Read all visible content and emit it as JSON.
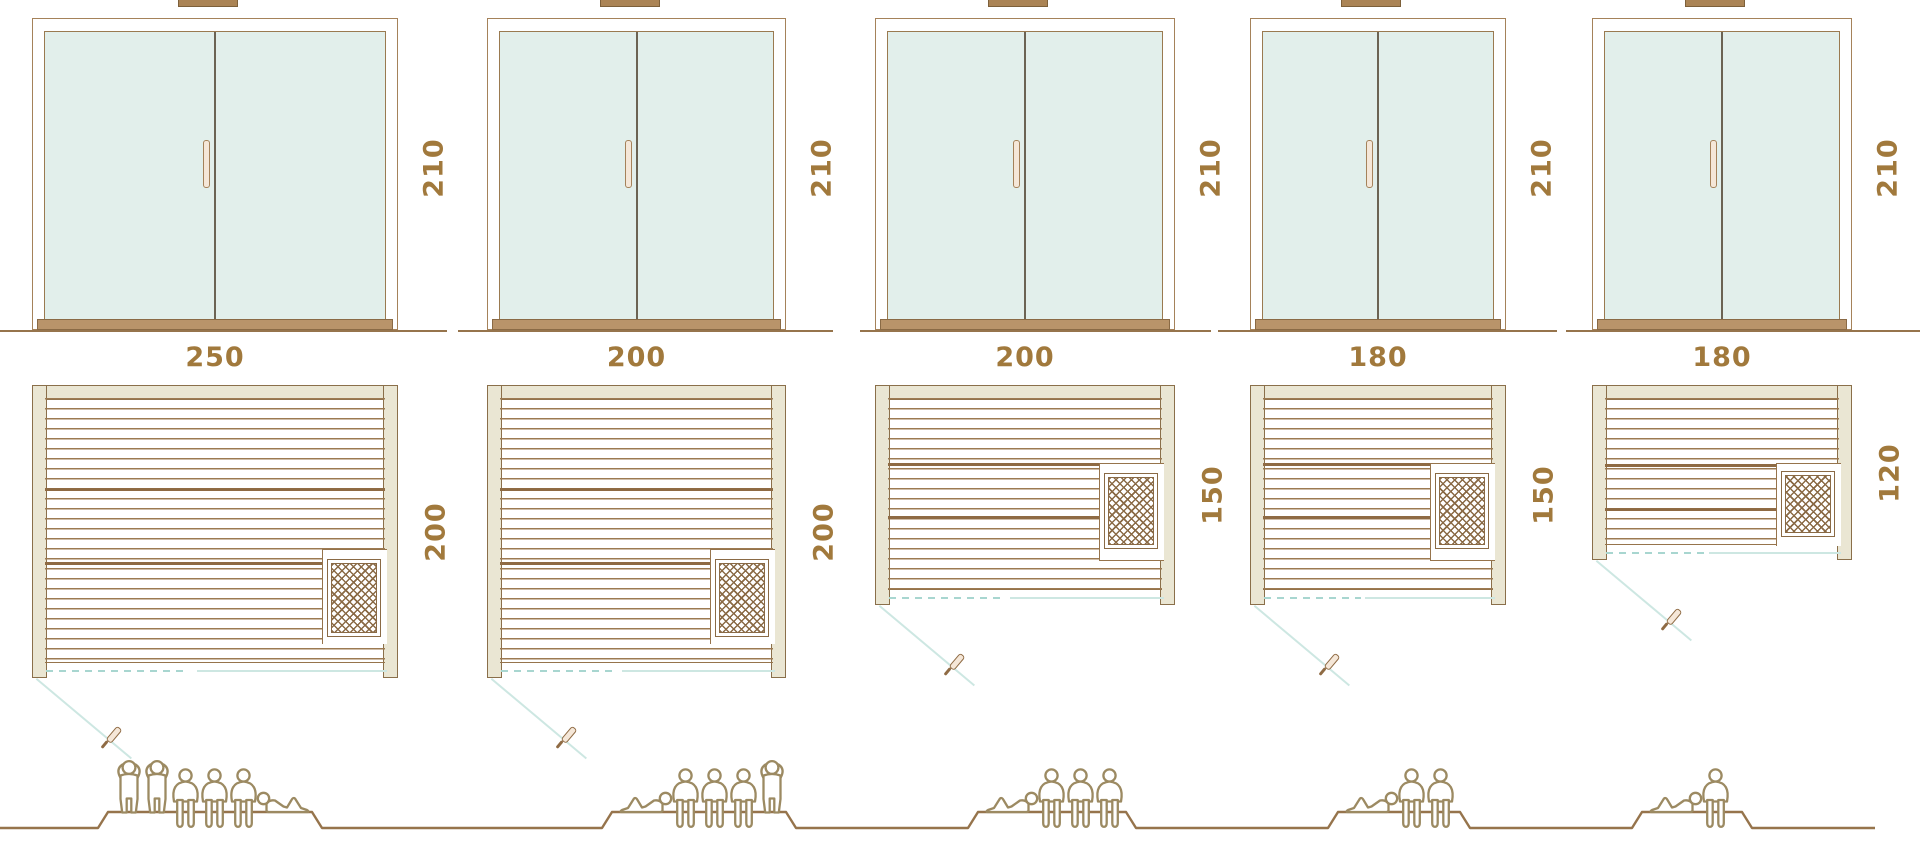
{
  "diagram": {
    "name": "sauna-size-comparison",
    "views": [
      "front-elevation",
      "floor-plan",
      "capacity"
    ]
  },
  "palette": {
    "line_brown": "#96744c",
    "frame_tan": "#a5825a",
    "dim_text": "#a1793c",
    "glass": "#e2efeb",
    "beige_fill": "#eae6d3",
    "swing_teal": "#cde7e2",
    "people_brown": "#9c8a62",
    "handle_cream": "#f5e7d8"
  },
  "units": [
    {
      "name": "sauna-250x200",
      "height_label": "210",
      "width_label": "250",
      "depth_label": "200",
      "capacity": 6,
      "people": [
        "standing",
        "standing",
        "sitting",
        "sitting",
        "sitting",
        "lying_right"
      ],
      "heater_position": "bottom-right",
      "door": "double-glass"
    },
    {
      "name": "sauna-200x200",
      "height_label": "210",
      "width_label": "200",
      "depth_label": "200",
      "capacity": 5,
      "people": [
        "lying_left",
        "sitting",
        "sitting",
        "sitting",
        "standing"
      ],
      "heater_position": "bottom-right",
      "door": "double-glass"
    },
    {
      "name": "sauna-200x150",
      "height_label": "210",
      "width_label": "200",
      "depth_label": "150",
      "capacity": 4,
      "people": [
        "lying_left",
        "sitting",
        "sitting",
        "sitting"
      ],
      "heater_position": "middle-right",
      "door": "double-glass"
    },
    {
      "name": "sauna-180x150",
      "height_label": "210",
      "width_label": "180",
      "depth_label": "150",
      "capacity": 3,
      "people": [
        "lying_left",
        "sitting",
        "sitting"
      ],
      "heater_position": "middle-right",
      "door": "double-glass"
    },
    {
      "name": "sauna-180x120",
      "height_label": "210",
      "width_label": "180",
      "depth_label": "120",
      "capacity": 2,
      "people": [
        "lying_left",
        "sitting"
      ],
      "heater_position": "middle-right",
      "door": "double-glass"
    }
  ]
}
